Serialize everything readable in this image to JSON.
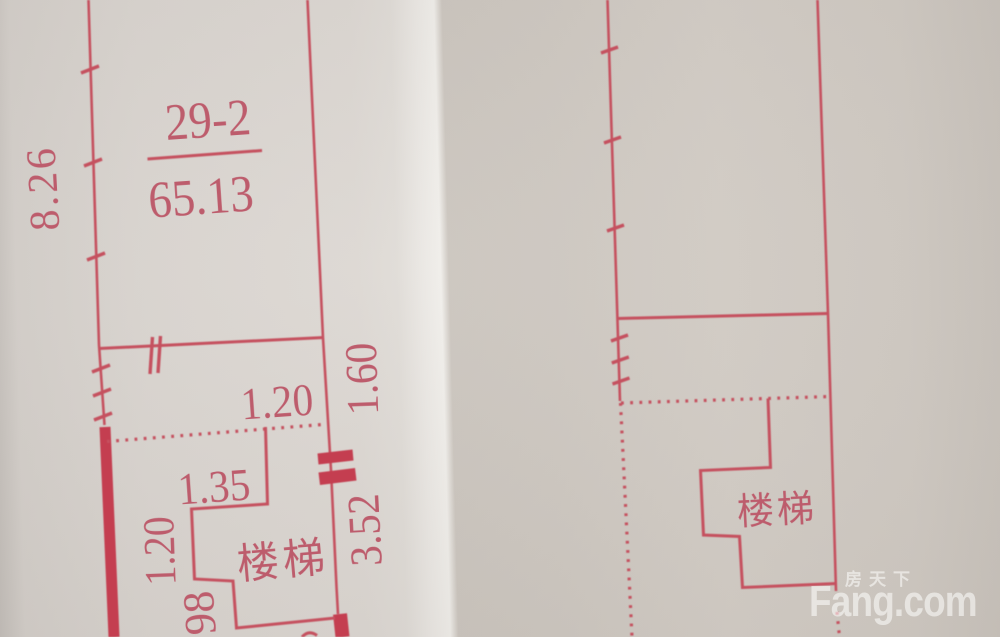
{
  "left_plan": {
    "room_number": "29-2",
    "area_value": "65.13",
    "stairs_label": "楼梯",
    "dims": {
      "left_height": "8.26",
      "top_width": "1.20",
      "right_upper_height": "1.60",
      "stairs_width": "1.35",
      "left_lower_height": "1.20",
      "right_lower_height": "3.52",
      "bottom_partial": "98"
    }
  },
  "right_plan": {
    "stairs_label": "楼梯"
  },
  "watermark": {
    "brand_cn": "房天下",
    "brand_en": "Fang.com"
  },
  "colors": {
    "line_red": "#c5515f",
    "wall_red": "#c43e50",
    "text_red": "#bd5c6c",
    "paper_left": "#d9d4cf",
    "paper_right": "#d0cac3",
    "fold_highlight": "#f0eeea"
  }
}
